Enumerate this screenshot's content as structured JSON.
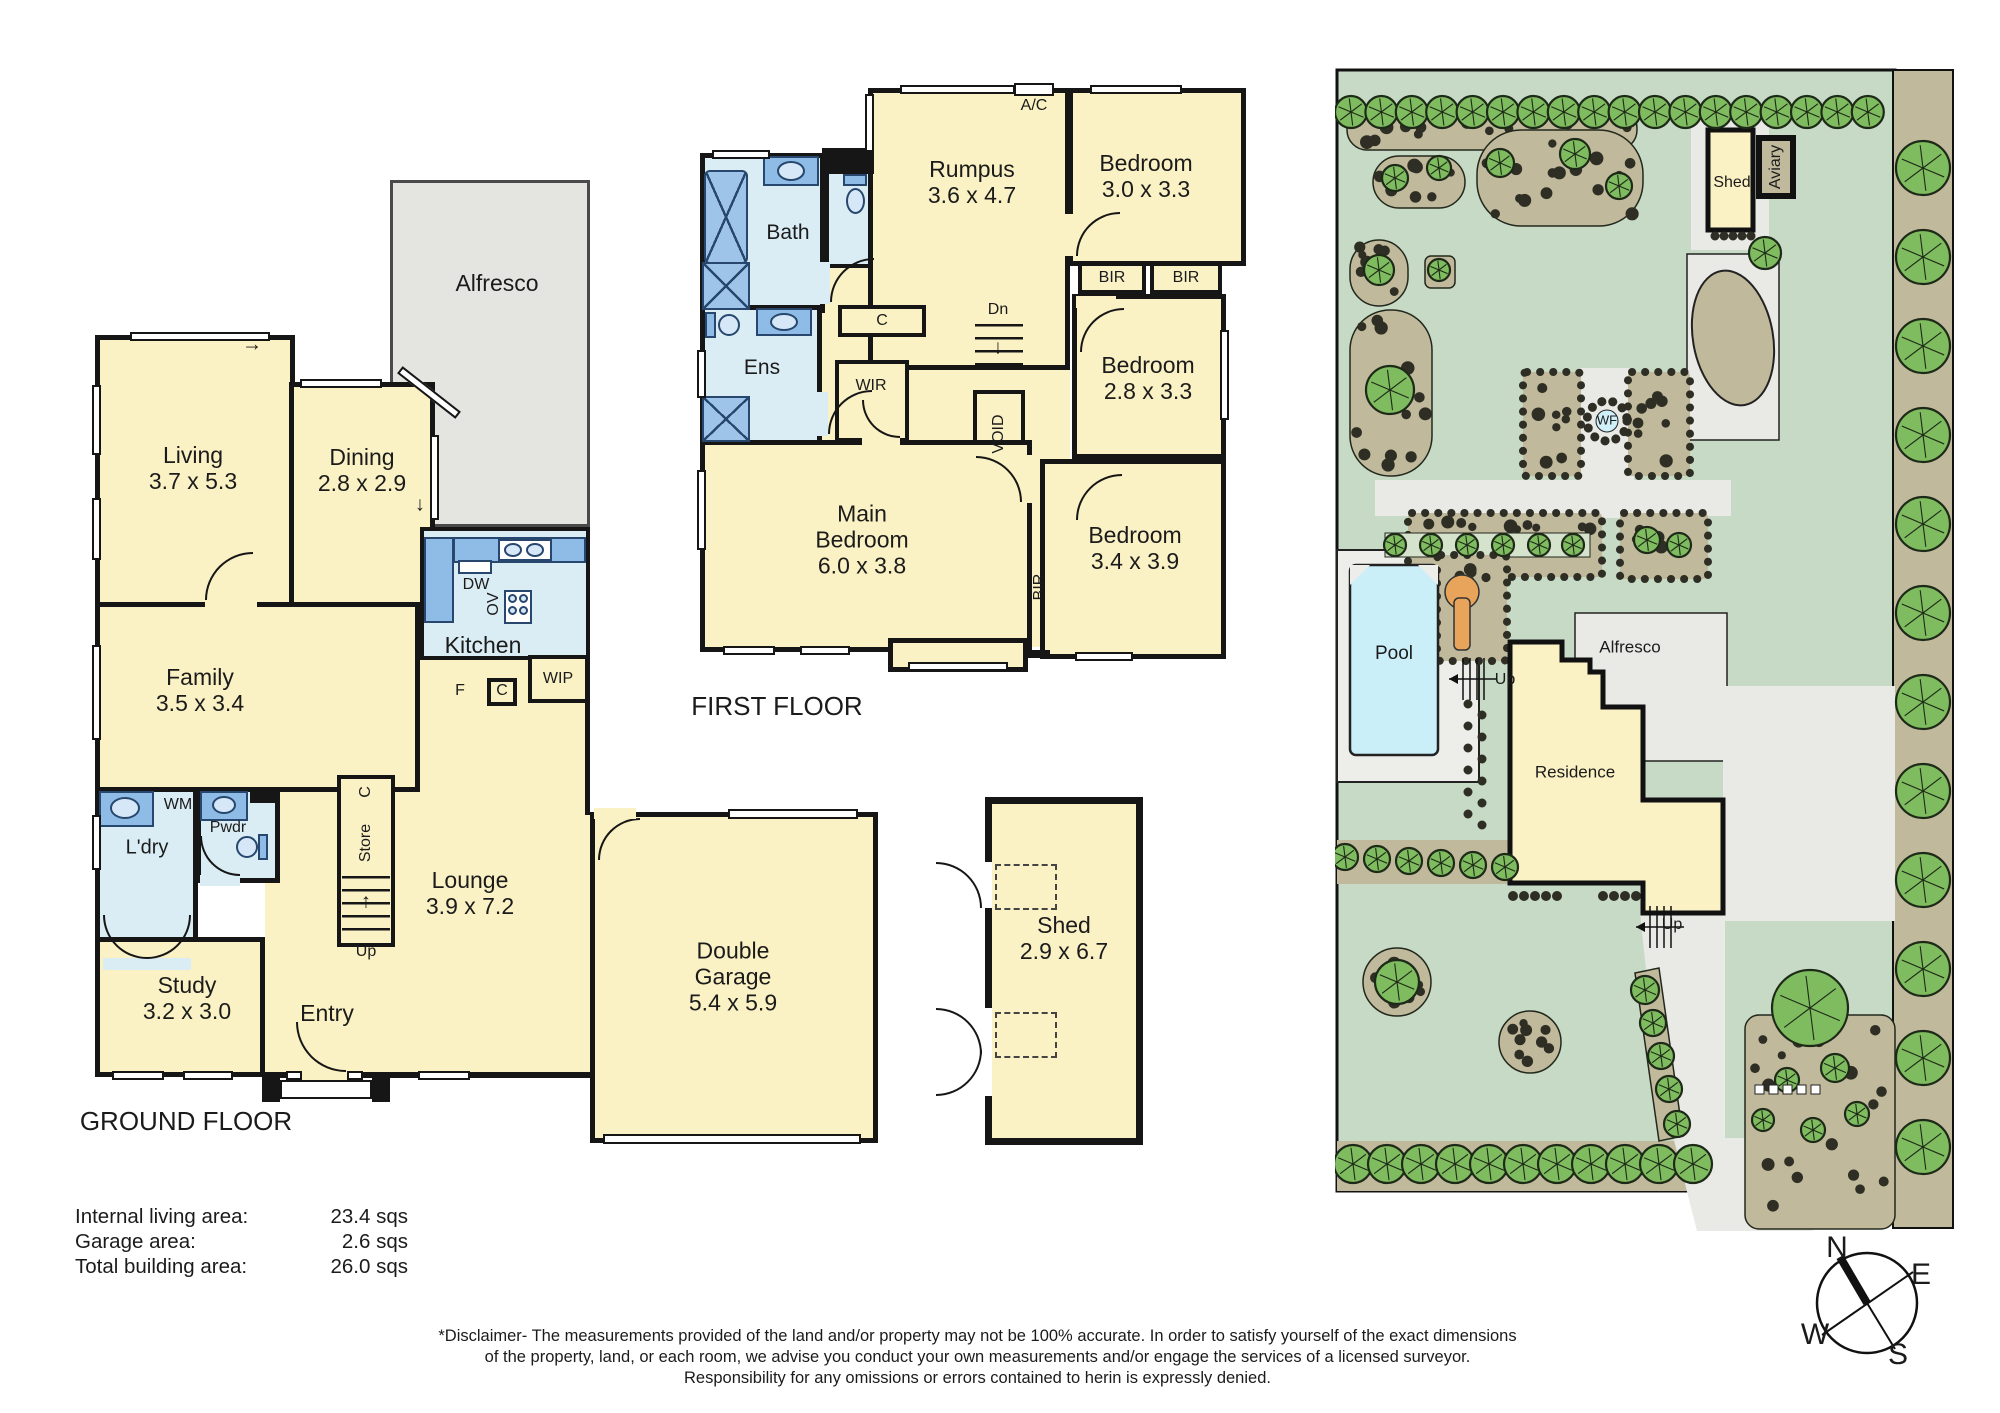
{
  "icons": {
    "arrow_up": "↑",
    "arrow_down": "↓",
    "arrow_right": "→",
    "arrow_left": "←"
  },
  "titles": {
    "ground_floor": "GROUND FLOOR",
    "first_floor": "FIRST FLOOR"
  },
  "ground_floor": {
    "living": {
      "name": "Living",
      "dims": "3.7 x 5.3"
    },
    "dining": {
      "name": "Dining",
      "dims": "2.8 x 2.9"
    },
    "alfresco": {
      "name": "Alfresco"
    },
    "kitchen": {
      "name": "Kitchen",
      "dw": "DW",
      "ov": "OV",
      "wip": "WIP",
      "f": "F",
      "c": "C"
    },
    "family": {
      "name": "Family",
      "dims": "3.5 x 3.4"
    },
    "laundry": {
      "name": "L'dry",
      "wm": "WM"
    },
    "powder": {
      "name": "Pwdr"
    },
    "stairs": {
      "c": "C",
      "store": "Store",
      "up": "Up"
    },
    "lounge": {
      "name": "Lounge",
      "dims": "3.9 x 7.2"
    },
    "study": {
      "name": "Study",
      "dims": "3.2 x 3.0"
    },
    "entry": {
      "name": "Entry"
    },
    "garage": {
      "name": "Double",
      "name2": "Garage",
      "dims": "5.4 x 5.9"
    }
  },
  "first_floor": {
    "bath": {
      "name": "Bath"
    },
    "ens": {
      "name": "Ens"
    },
    "rumpus": {
      "name": "Rumpus",
      "dims": "3.6 x 4.7"
    },
    "ac": "A/C",
    "bed1": {
      "name": "Bedroom",
      "dims": "3.0 x 3.3"
    },
    "bed2": {
      "name": "Bedroom",
      "dims": "2.8 x 3.3"
    },
    "bed3": {
      "name": "Bedroom",
      "dims": "3.4 x 3.9"
    },
    "main_bed": {
      "name1": "Main",
      "name2": "Bedroom",
      "dims": "6.0 x 3.8"
    },
    "bir": "BIR",
    "wir": "WIR",
    "c": "C",
    "void": "VOID",
    "dn": "Dn"
  },
  "shed_plan": {
    "name": "Shed",
    "dims": "2.9 x 6.7"
  },
  "site": {
    "shed": "Shed",
    "aviary": "Aviary",
    "wf": "WF",
    "pool": "Pool",
    "alfresco": "Alfresco",
    "residence": "Residence",
    "up_pool": "Up",
    "up_drive": "Up"
  },
  "areas": {
    "rows": [
      {
        "label": "Internal living area:",
        "value": "23.4 sqs"
      },
      {
        "label": "Garage area:",
        "value": "2.6 sqs"
      },
      {
        "label": "Total building area:",
        "value": "26.0 sqs"
      }
    ]
  },
  "disclaimer": {
    "line1": "*Disclaimer- The measurements provided of the land and/or property may not be 100% accurate. In order to satisfy yourself of the exact dimensions",
    "line2": "of the property, land, or each room, we advise you conduct your own measurements and/or engage the services of a licensed surveyor.",
    "line3": "Responsibility for any omissions or errors contained to herin is expressly denied."
  },
  "compass": {
    "n": "N",
    "e": "E",
    "w": "W",
    "s": "S"
  }
}
